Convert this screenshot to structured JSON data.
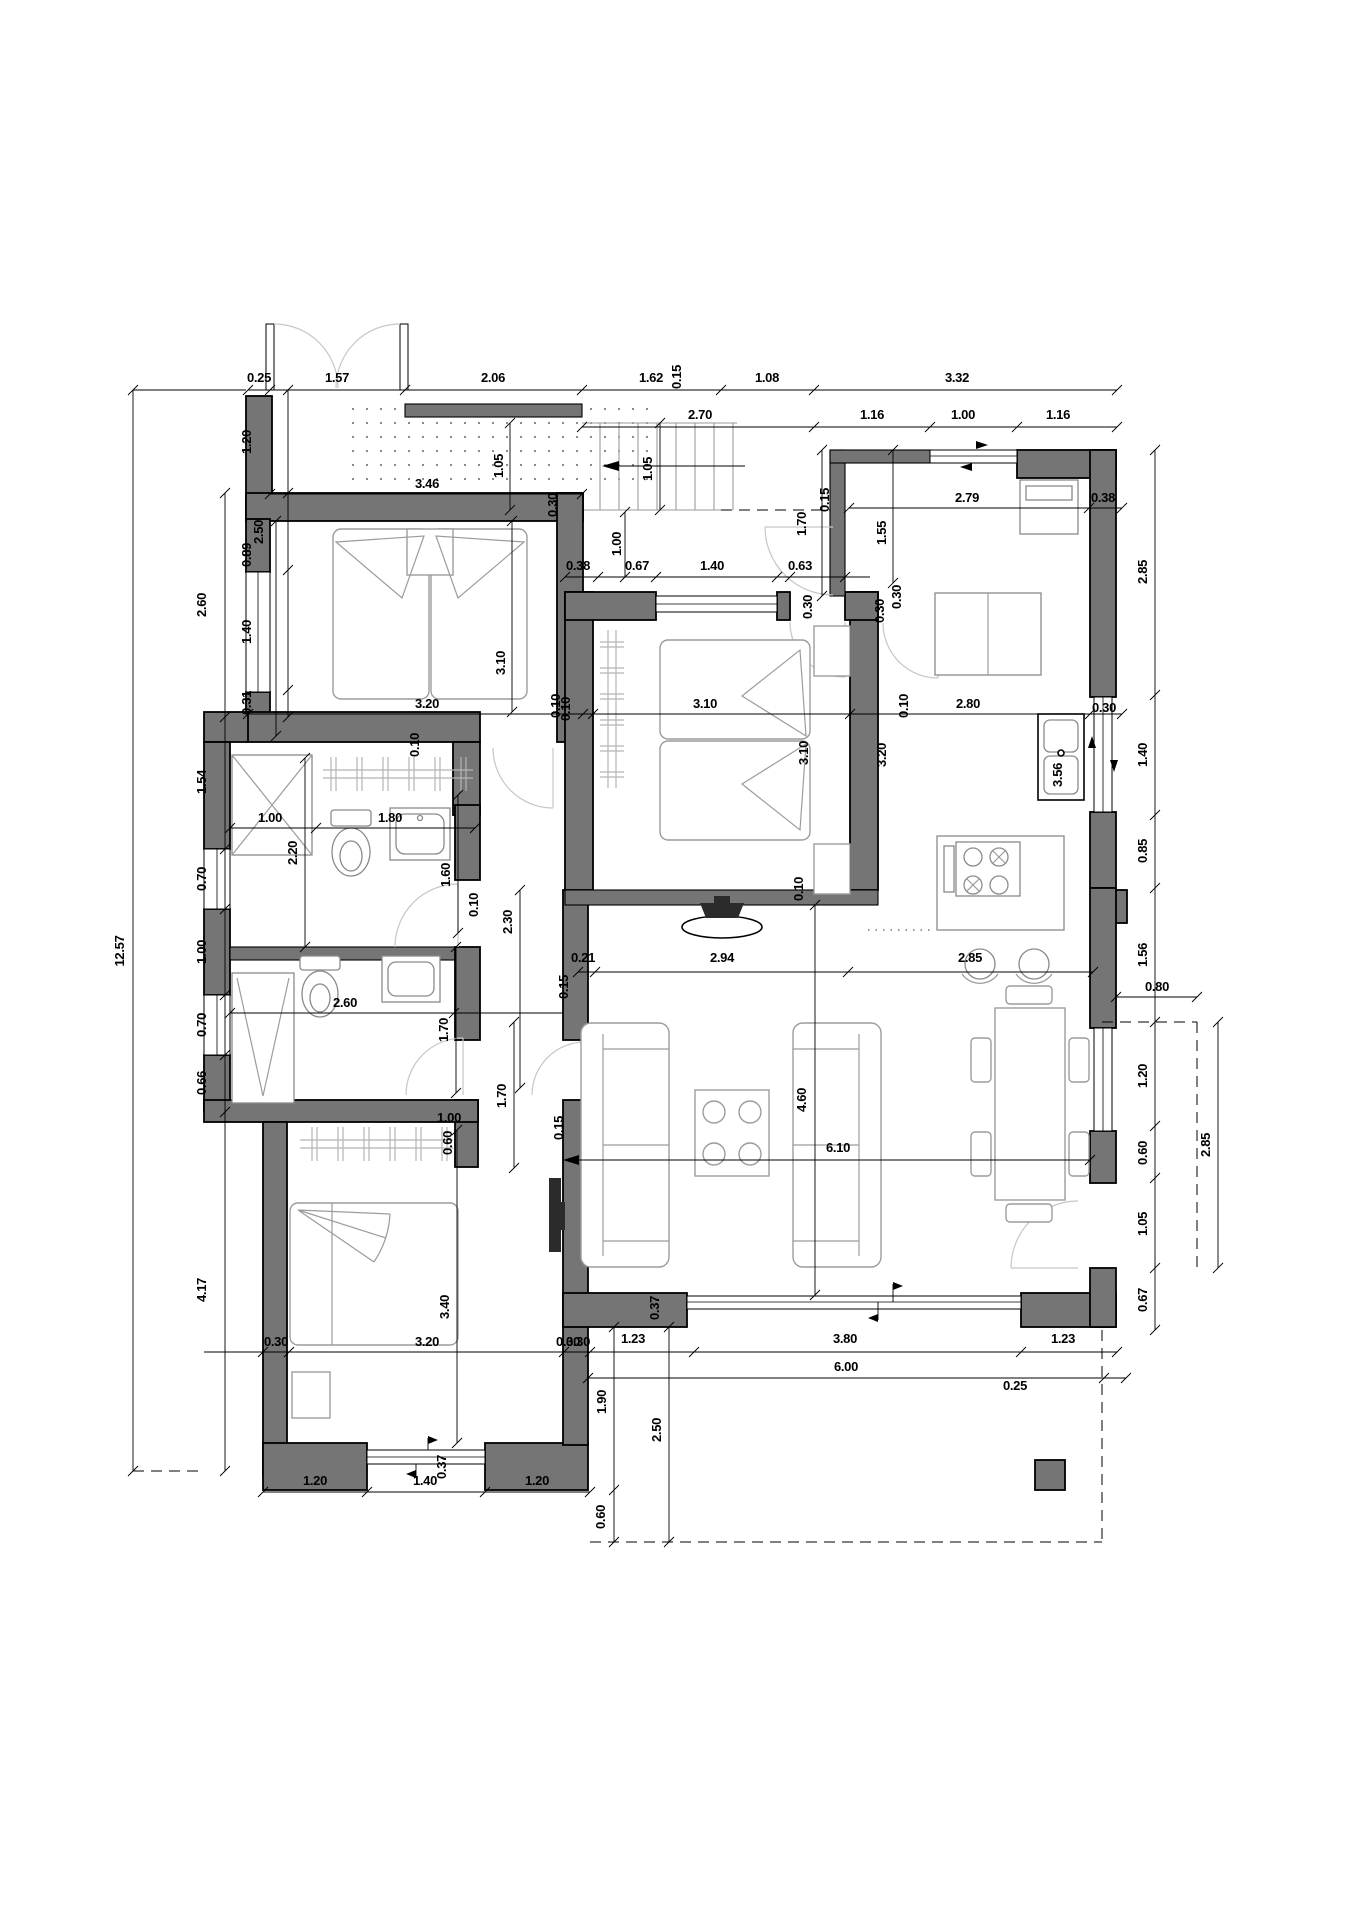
{
  "drawing": {
    "type": "floor-plan",
    "units": "meters",
    "colors": {
      "wall": "#757575",
      "lines": "#000000",
      "furniture": "#9c9c9c",
      "doors": "#c6c6c6",
      "background": "#ffffff"
    },
    "overall_width_label": "12.57"
  },
  "dimensions": [
    {
      "t": "0.25",
      "x": 259,
      "y": 382,
      "r": 0
    },
    {
      "t": "1.57",
      "x": 337,
      "y": 382,
      "r": 0
    },
    {
      "t": "2.06",
      "x": 493,
      "y": 382,
      "r": 0
    },
    {
      "t": "1.62",
      "x": 651,
      "y": 382,
      "r": 0
    },
    {
      "t": "1.08",
      "x": 767,
      "y": 382,
      "r": 0
    },
    {
      "t": "3.32",
      "x": 957,
      "y": 382,
      "r": 0
    },
    {
      "t": "2.70",
      "x": 700,
      "y": 419,
      "r": 0
    },
    {
      "t": "1.16",
      "x": 872,
      "y": 419,
      "r": 0
    },
    {
      "t": "1.00",
      "x": 963,
      "y": 419,
      "r": 0
    },
    {
      "t": "1.16",
      "x": 1058,
      "y": 419,
      "r": 0
    },
    {
      "t": "3.46",
      "x": 427,
      "y": 488,
      "r": 0
    },
    {
      "t": "1.05",
      "x": 503,
      "y": 466,
      "r": 1
    },
    {
      "t": "1.05",
      "x": 652,
      "y": 469,
      "r": 1
    },
    {
      "t": "0.30",
      "x": 557,
      "y": 505,
      "r": 1
    },
    {
      "t": "0.15",
      "x": 681,
      "y": 377,
      "r": 1
    },
    {
      "t": "2.79",
      "x": 967,
      "y": 502,
      "r": 0
    },
    {
      "t": "0.38",
      "x": 1103,
      "y": 502,
      "r": 0
    },
    {
      "t": "0.15",
      "x": 829,
      "y": 500,
      "r": 1
    },
    {
      "t": "1.70",
      "x": 806,
      "y": 524,
      "r": 1
    },
    {
      "t": "1.55",
      "x": 886,
      "y": 533,
      "r": 1
    },
    {
      "t": "1.00",
      "x": 621,
      "y": 544,
      "r": 1
    },
    {
      "t": "0.38",
      "x": 578,
      "y": 570,
      "r": 0
    },
    {
      "t": "0.67",
      "x": 637,
      "y": 570,
      "r": 0
    },
    {
      "t": "1.40",
      "x": 712,
      "y": 570,
      "r": 0
    },
    {
      "t": "0.63",
      "x": 800,
      "y": 570,
      "r": 0
    },
    {
      "t": "12.57",
      "x": 124,
      "y": 951,
      "r": 1
    },
    {
      "t": "2.60",
      "x": 206,
      "y": 605,
      "r": 1
    },
    {
      "t": "1.54",
      "x": 206,
      "y": 782,
      "r": 1
    },
    {
      "t": "0.70",
      "x": 206,
      "y": 879,
      "r": 1
    },
    {
      "t": "1.00",
      "x": 206,
      "y": 952,
      "r": 1
    },
    {
      "t": "0.70",
      "x": 206,
      "y": 1025,
      "r": 1
    },
    {
      "t": "0.66",
      "x": 206,
      "y": 1083,
      "r": 1
    },
    {
      "t": "4.17",
      "x": 206,
      "y": 1290,
      "r": 1
    },
    {
      "t": "1.20",
      "x": 251,
      "y": 442,
      "r": 1
    },
    {
      "t": "0.89",
      "x": 251,
      "y": 555,
      "r": 1
    },
    {
      "t": "1.40",
      "x": 251,
      "y": 632,
      "r": 1
    },
    {
      "t": "0.31",
      "x": 251,
      "y": 703,
      "r": 1
    },
    {
      "t": "2.50",
      "x": 263,
      "y": 532,
      "r": 1
    },
    {
      "t": "3.20",
      "x": 427,
      "y": 708,
      "r": 0
    },
    {
      "t": "3.10",
      "x": 505,
      "y": 663,
      "r": 1
    },
    {
      "t": "0.10",
      "x": 570,
      "y": 709,
      "r": 1
    },
    {
      "t": "1.00",
      "x": 270,
      "y": 822,
      "r": 0
    },
    {
      "t": "1.80",
      "x": 390,
      "y": 822,
      "r": 0
    },
    {
      "t": "2.20",
      "x": 297,
      "y": 853,
      "r": 1
    },
    {
      "t": "1.60",
      "x": 450,
      "y": 875,
      "r": 1
    },
    {
      "t": "0.10",
      "x": 419,
      "y": 745,
      "r": 1
    },
    {
      "t": "3.10",
      "x": 705,
      "y": 708,
      "r": 0
    },
    {
      "t": "3.10",
      "x": 808,
      "y": 753,
      "r": 1
    },
    {
      "t": "3.20",
      "x": 886,
      "y": 755,
      "r": 1
    },
    {
      "t": "0.30",
      "x": 812,
      "y": 607,
      "r": 1
    },
    {
      "t": "0.30",
      "x": 884,
      "y": 611,
      "r": 1
    },
    {
      "t": "0.10",
      "x": 560,
      "y": 706,
      "r": 1
    },
    {
      "t": "0.10",
      "x": 908,
      "y": 706,
      "r": 1
    },
    {
      "t": "0.10",
      "x": 803,
      "y": 889,
      "r": 1
    },
    {
      "t": "2.80",
      "x": 968,
      "y": 708,
      "r": 0
    },
    {
      "t": "0.30",
      "x": 901,
      "y": 597,
      "r": 1
    },
    {
      "t": "3.56",
      "x": 1062,
      "y": 775,
      "r": 1
    },
    {
      "t": "0.30",
      "x": 1104,
      "y": 712,
      "r": 0
    },
    {
      "t": "2.85",
      "x": 1147,
      "y": 572,
      "r": 1
    },
    {
      "t": "1.40",
      "x": 1147,
      "y": 755,
      "r": 1
    },
    {
      "t": "0.85",
      "x": 1147,
      "y": 851,
      "r": 1
    },
    {
      "t": "1.56",
      "x": 1147,
      "y": 955,
      "r": 1
    },
    {
      "t": "2.60",
      "x": 345,
      "y": 1007,
      "r": 0
    },
    {
      "t": "2.30",
      "x": 512,
      "y": 922,
      "r": 1
    },
    {
      "t": "0.10",
      "x": 478,
      "y": 905,
      "r": 1
    },
    {
      "t": "1.70",
      "x": 448,
      "y": 1030,
      "r": 1
    },
    {
      "t": "1.70",
      "x": 506,
      "y": 1096,
      "r": 1
    },
    {
      "t": "0.60",
      "x": 452,
      "y": 1143,
      "r": 1
    },
    {
      "t": "0.21",
      "x": 583,
      "y": 962,
      "r": 0
    },
    {
      "t": "2.94",
      "x": 722,
      "y": 962,
      "r": 0
    },
    {
      "t": "2.85",
      "x": 970,
      "y": 962,
      "r": 0
    },
    {
      "t": "0.15",
      "x": 568,
      "y": 987,
      "r": 1
    },
    {
      "t": "1.00",
      "x": 449,
      "y": 1122,
      "r": 0
    },
    {
      "t": "0.15",
      "x": 563,
      "y": 1128,
      "r": 1
    },
    {
      "t": "4.60",
      "x": 806,
      "y": 1100,
      "r": 1
    },
    {
      "t": "6.10",
      "x": 838,
      "y": 1152,
      "r": 0
    },
    {
      "t": "0.80",
      "x": 1157,
      "y": 991,
      "r": 0
    },
    {
      "t": "1.20",
      "x": 1147,
      "y": 1076,
      "r": 1
    },
    {
      "t": "0.60",
      "x": 1147,
      "y": 1153,
      "r": 1
    },
    {
      "t": "1.05",
      "x": 1147,
      "y": 1224,
      "r": 1
    },
    {
      "t": "0.67",
      "x": 1147,
      "y": 1300,
      "r": 1
    },
    {
      "t": "2.85",
      "x": 1210,
      "y": 1145,
      "r": 1
    },
    {
      "t": "0.37",
      "x": 659,
      "y": 1308,
      "r": 1
    },
    {
      "t": "0.30",
      "x": 568,
      "y": 1346,
      "r": 0
    },
    {
      "t": "1.23",
      "x": 633,
      "y": 1343,
      "r": 0
    },
    {
      "t": "3.80",
      "x": 845,
      "y": 1343,
      "r": 0
    },
    {
      "t": "1.23",
      "x": 1063,
      "y": 1343,
      "r": 0
    },
    {
      "t": "6.00",
      "x": 846,
      "y": 1371,
      "r": 0
    },
    {
      "t": "0.25",
      "x": 1015,
      "y": 1390,
      "r": 0
    },
    {
      "t": "1.90",
      "x": 606,
      "y": 1402,
      "r": 1
    },
    {
      "t": "2.50",
      "x": 661,
      "y": 1430,
      "r": 1
    },
    {
      "t": "0.60",
      "x": 605,
      "y": 1517,
      "r": 1
    },
    {
      "t": "3.40",
      "x": 449,
      "y": 1307,
      "r": 1
    },
    {
      "t": "0.30",
      "x": 276,
      "y": 1346,
      "r": 0
    },
    {
      "t": "3.20",
      "x": 427,
      "y": 1346,
      "r": 0
    },
    {
      "t": "0.30",
      "x": 578,
      "y": 1346,
      "r": 0
    },
    {
      "t": "0.37",
      "x": 446,
      "y": 1467,
      "r": 1
    },
    {
      "t": "1.20",
      "x": 315,
      "y": 1485,
      "r": 0
    },
    {
      "t": "1.40",
      "x": 425,
      "y": 1485,
      "r": 0
    },
    {
      "t": "1.20",
      "x": 537,
      "y": 1485,
      "r": 0
    }
  ]
}
